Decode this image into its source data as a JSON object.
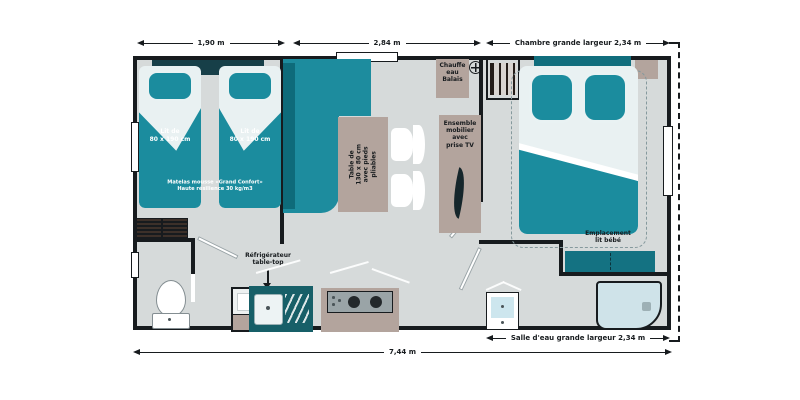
{
  "dimensions": {
    "top": [
      {
        "label": "1,90 m"
      },
      {
        "label": "2,84 m"
      },
      {
        "label": "Chambre grande largeur 2,34 m"
      }
    ],
    "bottom": [
      {
        "label": "Salle d'eau grande largeur 2,34 m"
      },
      {
        "label": "7,44 m"
      }
    ]
  },
  "labels": {
    "bed_single_1": "Lit de\n80 x 190 cm",
    "bed_single_2": "Lit de\n80 x 190 cm",
    "mattress_note": "Matelas mousse «Grand Confort»\nHaute résilience 30 kg/m3",
    "table": "Table de\n130 x 80 cm\navec pieds pliables",
    "water_heater": "Chauffe\neau\nBalais",
    "furniture_tv": "Ensemble\nmobilier\navec\nprise TV",
    "baby_bed": "Emplacement\nlit bébé",
    "fridge": "Réfrigérateur\ntable-top"
  },
  "colors": {
    "teal": "#1b8c9e",
    "dark_teal": "#175f68",
    "taupe": "#b3a49d",
    "floor_gray": "#d6dada",
    "wall_black": "#171b1e",
    "linen": "#e9f1f2"
  }
}
